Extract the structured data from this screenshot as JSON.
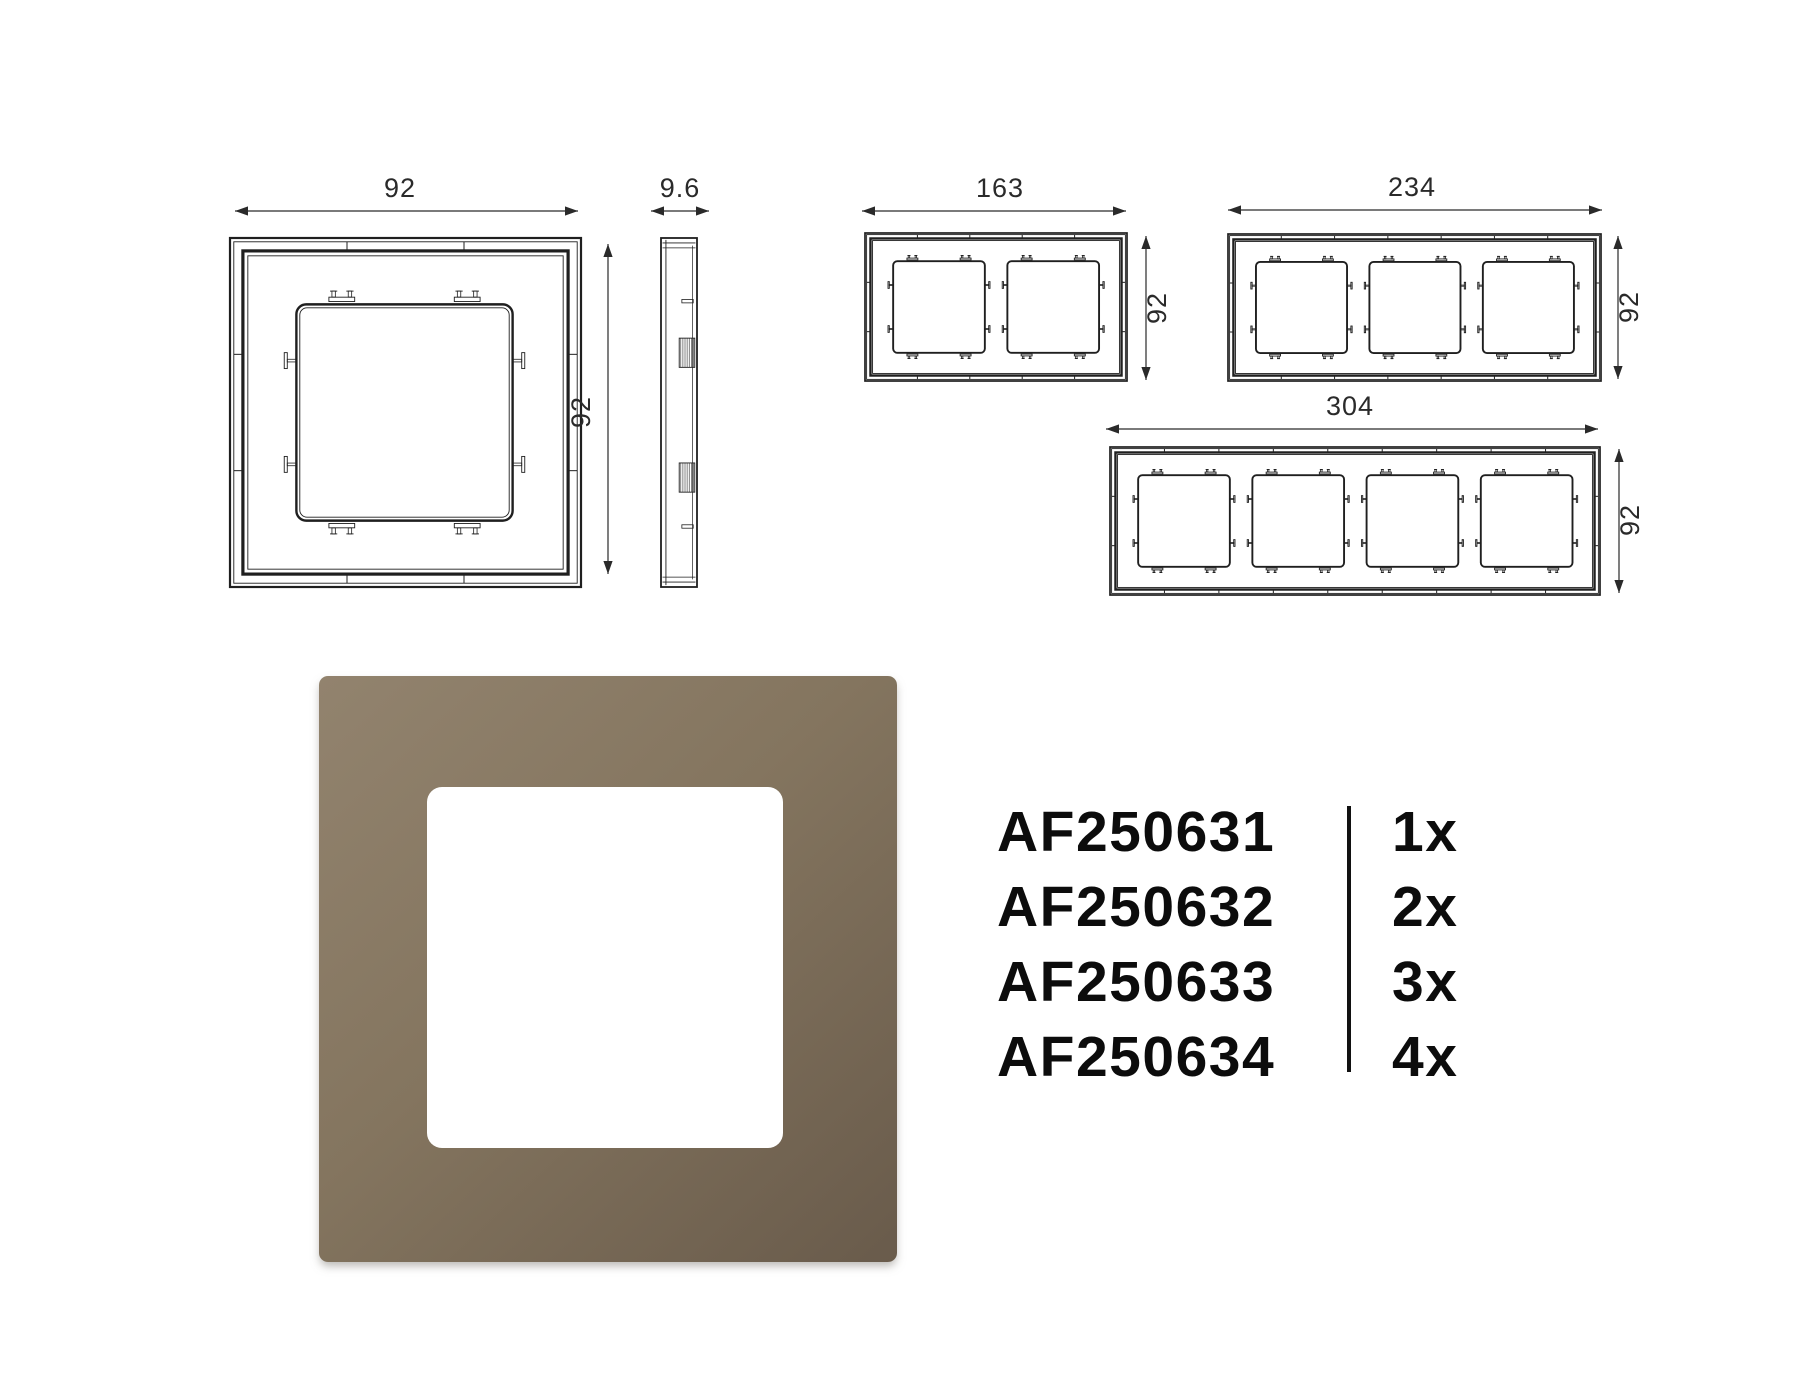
{
  "page": {
    "background": "#ffffff"
  },
  "diagram": {
    "stroke": "#1f1f1f",
    "dim_color": "#2a2a2a",
    "front_views": [
      {
        "name": "front-view-1-gang",
        "gangs": 1,
        "x": 230,
        "y": 238,
        "w": 351,
        "h": 349
      },
      {
        "name": "front-view-2-gang",
        "gangs": 2,
        "x": 865,
        "y": 233,
        "w": 262,
        "h": 148
      },
      {
        "name": "front-view-3-gang",
        "gangs": 3,
        "x": 1228,
        "y": 234,
        "w": 373,
        "h": 147
      },
      {
        "name": "front-view-4-gang",
        "gangs": 4,
        "x": 1110,
        "y": 447,
        "w": 490,
        "h": 148
      }
    ],
    "side_view": {
      "name": "side-view-1-gang",
      "x": 661,
      "y": 238,
      "w": 36,
      "h": 349
    },
    "dims": [
      {
        "kind": "h",
        "label": "92",
        "x1": 235,
        "x2": 578,
        "y": 211,
        "lx": 400,
        "ly": 197
      },
      {
        "kind": "h",
        "label": "9.6",
        "x1": 651,
        "x2": 709,
        "y": 211,
        "lx": 680,
        "ly": 197
      },
      {
        "kind": "h",
        "label": "163",
        "x1": 862,
        "x2": 1126,
        "y": 211,
        "lx": 1000,
        "ly": 197
      },
      {
        "kind": "h",
        "label": "234",
        "x1": 1228,
        "x2": 1602,
        "y": 210,
        "lx": 1412,
        "ly": 196
      },
      {
        "kind": "h",
        "label": "304",
        "x1": 1106,
        "x2": 1598,
        "y": 429,
        "lx": 1350,
        "ly": 415
      },
      {
        "kind": "v",
        "label": "92",
        "x": 608,
        "y1": 244,
        "y2": 574,
        "lx": 590,
        "ly": 412
      },
      {
        "kind": "v",
        "label": "92",
        "x": 1146,
        "y1": 236,
        "y2": 380,
        "lx": 1166,
        "ly": 308
      },
      {
        "kind": "v",
        "label": "92",
        "x": 1618,
        "y1": 236,
        "y2": 379,
        "lx": 1638,
        "ly": 307
      },
      {
        "kind": "v",
        "label": "92",
        "x": 1619,
        "y1": 449,
        "y2": 593,
        "lx": 1639,
        "ly": 520
      }
    ]
  },
  "product": {
    "description": "1-gang frame render, taupe/bronze finish",
    "gradient": {
      "angle": 137,
      "from": "#92836e",
      "mid": "#84755f",
      "to": "#695b4b"
    },
    "cutout_color": "#ffffff"
  },
  "parts_table": {
    "rows": [
      {
        "code": "AF250631",
        "qty": "1x"
      },
      {
        "code": "AF250632",
        "qty": "2x"
      },
      {
        "code": "AF250633",
        "qty": "3x"
      },
      {
        "code": "AF250634",
        "qty": "4x"
      }
    ]
  }
}
